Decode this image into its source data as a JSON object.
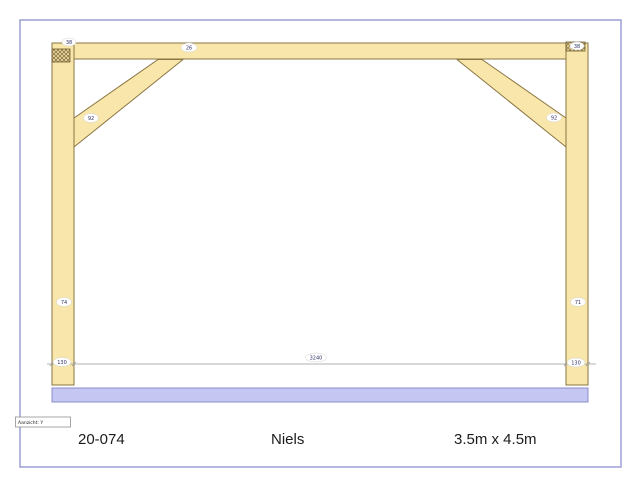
{
  "sheet": {
    "background": "#ffffff",
    "border_color": "#9b9fd6"
  },
  "drawing": {
    "colors": {
      "timber_fill": "#f8e6aa",
      "timber_stroke": "#8a7544",
      "sill_fill": "#c6c6f2",
      "sill_stroke": "#8b8cc9",
      "dimension_line": "#9a9a9a",
      "label_text": "#333366"
    },
    "part_labels": {
      "post_left_top": "38",
      "beam": "26",
      "post_right_top": "38",
      "brace_left": "92",
      "brace_right": "92",
      "post_left": "74",
      "post_right": "71"
    },
    "dimensions": {
      "left_offset": "130",
      "span": "3240",
      "right_offset": "130"
    },
    "view_label": "Aanzicht: Y"
  },
  "footer": {
    "project_number": "20-074",
    "client_name": "Niels",
    "size_label": "3.5m x 4.5m"
  }
}
